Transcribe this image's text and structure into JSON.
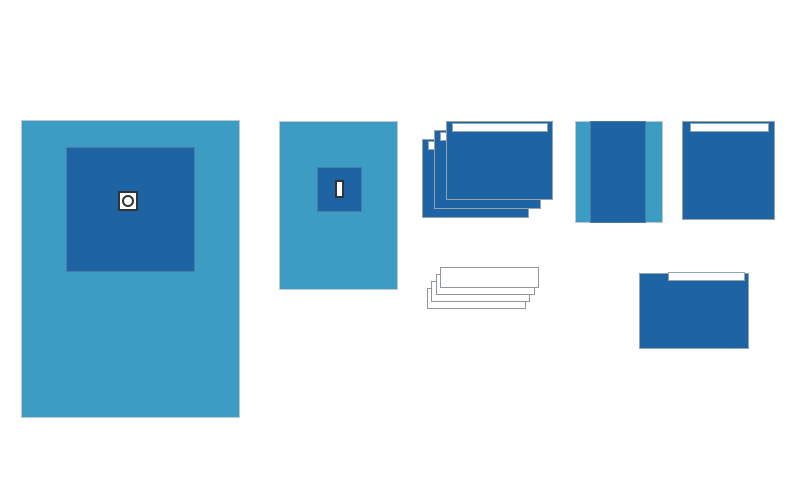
{
  "canvas": {
    "width": 800,
    "height": 489,
    "background": "#FFFFFF"
  },
  "palette": {
    "light_blue": "#3C9CC4",
    "dark_blue": "#1E64A5",
    "outline_light": "#BCC7CE",
    "outline_mid": "#97A3AB",
    "inner_edge": "#4A7CA6",
    "fenestration_edge": "#333333",
    "towel_edge": "#8F979D",
    "white": "#FFFFFF"
  },
  "items": [
    {
      "name": "large-fenestrated-drape",
      "parts": [
        {
          "name": "large-drape-sheet",
          "shape": "rect",
          "x": 21,
          "y": 120,
          "w": 219,
          "h": 298,
          "fill": "light_blue",
          "border": "outline_light",
          "bw": 1
        },
        {
          "name": "large-drape-reinforcement",
          "shape": "rect",
          "x": 66,
          "y": 147,
          "w": 129,
          "h": 125,
          "fill": "dark_blue",
          "border": "inner_edge",
          "bw": 1
        },
        {
          "name": "large-drape-fenestration",
          "shape": "rect",
          "x": 118,
          "y": 191,
          "w": 20,
          "h": 20,
          "fill": "white",
          "border": "fenestration_edge",
          "bw": 2
        },
        {
          "name": "large-drape-fenestration-hole",
          "shape": "ring",
          "x": 122,
          "y": 195,
          "w": 12,
          "h": 12,
          "fill": "white",
          "border": "fenestration_edge",
          "bw": 2
        }
      ]
    },
    {
      "name": "small-fenestrated-drape",
      "parts": [
        {
          "name": "small-drape-sheet",
          "shape": "rect",
          "x": 279,
          "y": 121,
          "w": 119,
          "h": 169,
          "fill": "light_blue",
          "border": "outline_light",
          "bw": 1
        },
        {
          "name": "small-drape-reinforcement",
          "shape": "rect",
          "x": 317,
          "y": 167,
          "w": 45,
          "h": 45,
          "fill": "dark_blue",
          "border": "inner_edge",
          "bw": 1
        },
        {
          "name": "small-drape-fenestration-slot",
          "shape": "rect",
          "x": 335,
          "y": 180,
          "w": 9,
          "h": 18,
          "fill": "white",
          "border": "fenestration_edge",
          "bw": 2
        }
      ]
    },
    {
      "name": "incise-drape-stack",
      "parts": [
        {
          "name": "incise-drape-back-sheet",
          "shape": "rect",
          "x": 422,
          "y": 139,
          "w": 107,
          "h": 79,
          "fill": "dark_blue",
          "border": "outline_mid",
          "bw": 1
        },
        {
          "name": "incise-drape-back-strip",
          "shape": "rect",
          "x": 428,
          "y": 141,
          "w": 96,
          "h": 9,
          "fill": "white",
          "border": "outline_mid",
          "bw": 1
        },
        {
          "name": "incise-drape-middle-sheet",
          "shape": "rect",
          "x": 434,
          "y": 130,
          "w": 107,
          "h": 79,
          "fill": "dark_blue",
          "border": "outline_mid",
          "bw": 1
        },
        {
          "name": "incise-drape-middle-strip",
          "shape": "rect",
          "x": 440,
          "y": 132,
          "w": 96,
          "h": 9,
          "fill": "white",
          "border": "outline_mid",
          "bw": 1
        },
        {
          "name": "incise-drape-front-sheet",
          "shape": "rect",
          "x": 446,
          "y": 121,
          "w": 107,
          "h": 79,
          "fill": "dark_blue",
          "border": "outline_mid",
          "bw": 1
        },
        {
          "name": "incise-drape-front-strip",
          "shape": "rect",
          "x": 452,
          "y": 123,
          "w": 96,
          "h": 9,
          "fill": "white",
          "border": "outline_mid",
          "bw": 1
        }
      ]
    },
    {
      "name": "towel-stack",
      "parts": [
        {
          "name": "towel-4",
          "shape": "rect",
          "x": 427,
          "y": 288,
          "w": 99,
          "h": 21,
          "fill": "white",
          "border": "towel_edge",
          "bw": 1
        },
        {
          "name": "towel-3",
          "shape": "rect",
          "x": 431,
          "y": 281,
          "w": 99,
          "h": 21,
          "fill": "white",
          "border": "towel_edge",
          "bw": 1
        },
        {
          "name": "towel-2",
          "shape": "rect",
          "x": 436,
          "y": 274,
          "w": 99,
          "h": 21,
          "fill": "white",
          "border": "towel_edge",
          "bw": 1
        },
        {
          "name": "towel-1",
          "shape": "rect",
          "x": 440,
          "y": 267,
          "w": 99,
          "h": 21,
          "fill": "white",
          "border": "towel_edge",
          "bw": 1
        }
      ]
    },
    {
      "name": "mayo-stand-cover",
      "parts": [
        {
          "name": "mayo-cover-sheet",
          "shape": "rect",
          "x": 575,
          "y": 121,
          "w": 88,
          "h": 102,
          "fill": "light_blue",
          "border": "outline_light",
          "bw": 1
        },
        {
          "name": "mayo-cover-center-band",
          "shape": "rect",
          "x": 590,
          "y": 121,
          "w": 56,
          "h": 102,
          "fill": "dark_blue",
          "border": "inner_edge",
          "bw": 1
        }
      ]
    },
    {
      "name": "side-adhesive-drape",
      "parts": [
        {
          "name": "side-drape-sheet",
          "shape": "rect",
          "x": 682,
          "y": 121,
          "w": 93,
          "h": 99,
          "fill": "dark_blue",
          "border": "outline_mid",
          "bw": 1
        },
        {
          "name": "side-drape-tape-strip",
          "shape": "rect",
          "x": 690,
          "y": 123,
          "w": 79,
          "h": 9,
          "fill": "white",
          "border": "outline_mid",
          "bw": 1
        }
      ]
    },
    {
      "name": "bottom-adhesive-drape",
      "parts": [
        {
          "name": "bottom-drape-sheet",
          "shape": "rect",
          "x": 639,
          "y": 273,
          "w": 110,
          "h": 76,
          "fill": "dark_blue",
          "border": "outline_mid",
          "bw": 1
        },
        {
          "name": "bottom-drape-tape-strip",
          "shape": "rect",
          "x": 668,
          "y": 272,
          "w": 77,
          "h": 9,
          "fill": "white",
          "border": "outline_mid",
          "bw": 1
        }
      ]
    }
  ]
}
